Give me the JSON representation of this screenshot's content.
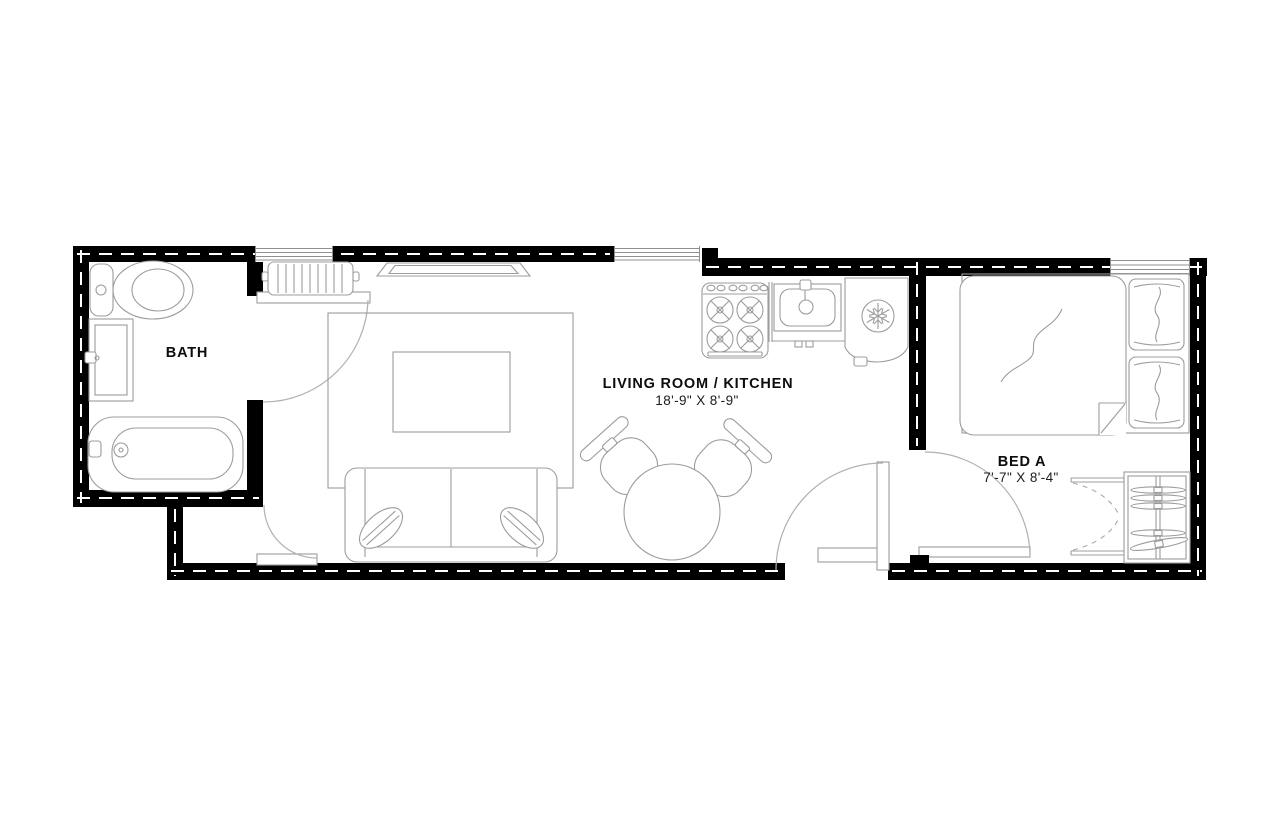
{
  "colors": {
    "wall": "#000000",
    "furniture_line": "#9c9c9c",
    "background": "#ffffff",
    "text": "#0c0c0c"
  },
  "rooms": {
    "bath": {
      "label": "BATH",
      "furniture": [
        "toilet",
        "vanity-sink",
        "bathtub"
      ]
    },
    "living_kitchen": {
      "label": "LIVING ROOM / KITCHEN",
      "dimensions": "18'-9\" X 8'-9\"",
      "furniture": [
        "radiator",
        "tv-console",
        "area-rug",
        "coffee-table",
        "sofa",
        "throw-pillows",
        "dining-table",
        "dining-chairs",
        "stove",
        "kitchen-sink",
        "refrigerator"
      ]
    },
    "bed_a": {
      "label": "BED A",
      "dimensions": "7'-7\" X 8'-4\"",
      "furniture": [
        "double-bed",
        "pillows",
        "wardrobe-closet"
      ]
    }
  },
  "openings": {
    "windows": 3,
    "doors": [
      "entry-door",
      "bath-door",
      "hall-door",
      "bedroom-door",
      "closet-bifold-doors"
    ]
  }
}
